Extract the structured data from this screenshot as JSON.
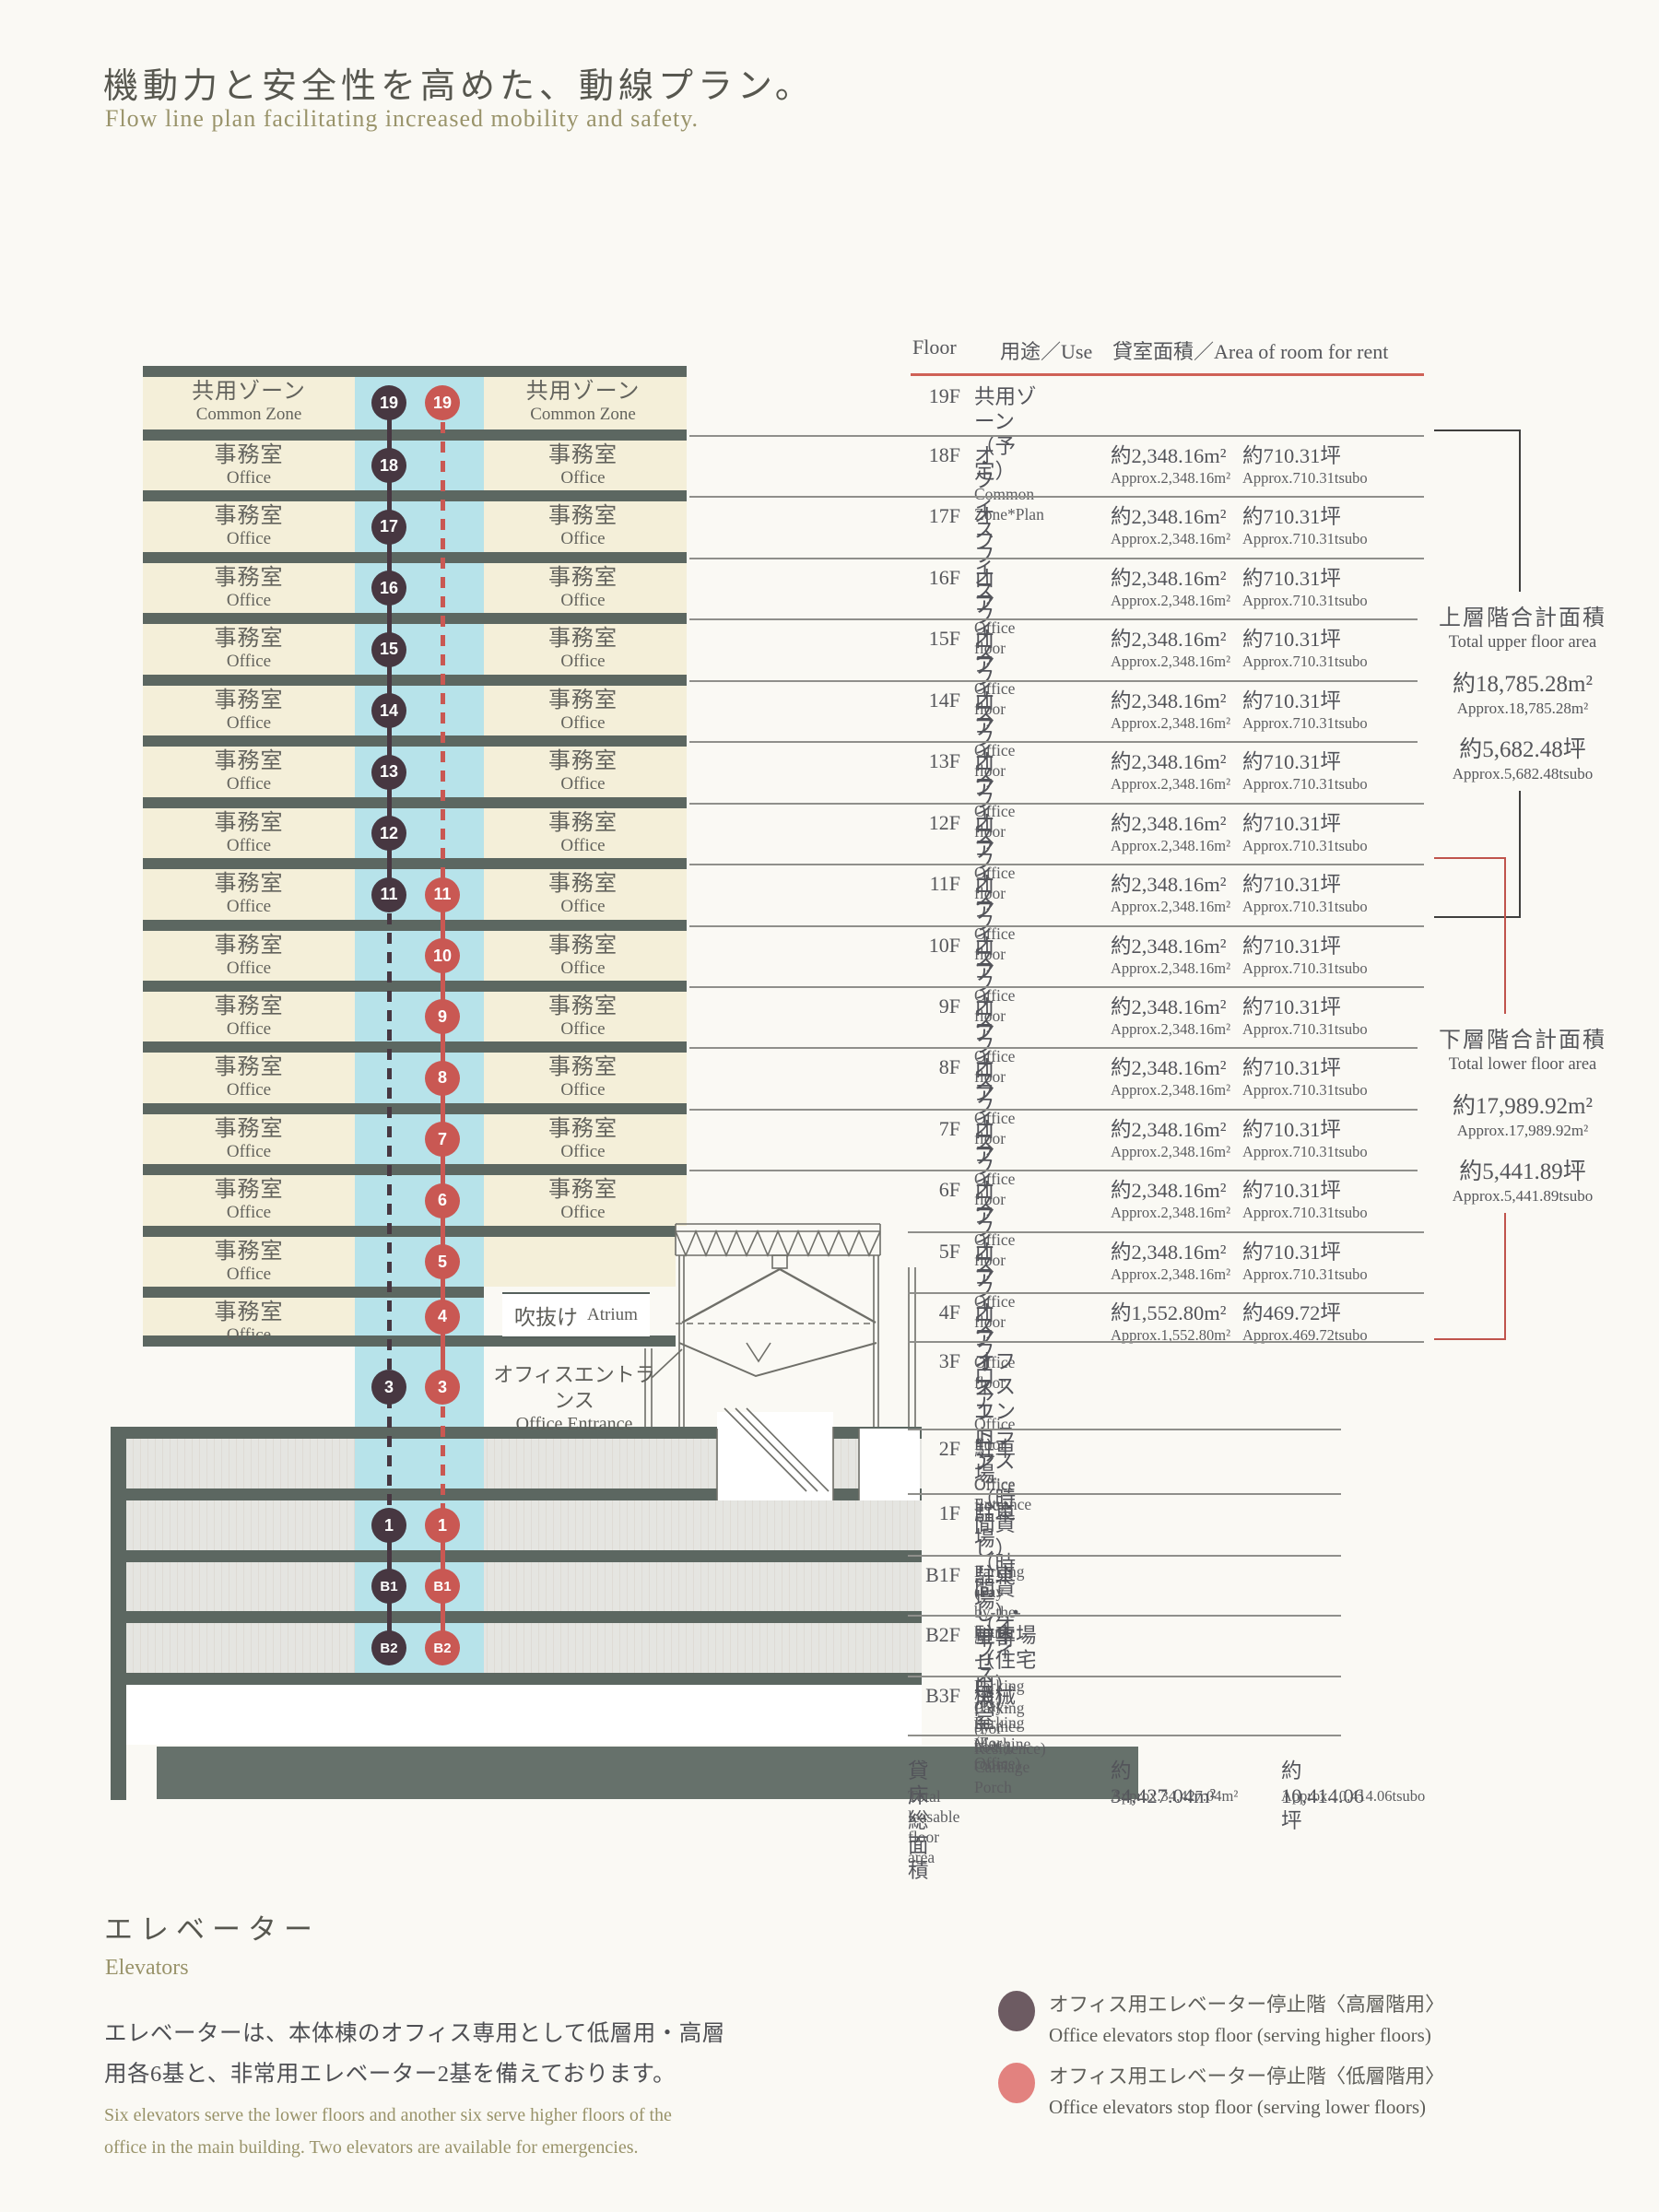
{
  "page": {
    "title_jp": "機動力と安全性を高めた、動線プラン。",
    "subtitle_en": "Flow line plan facilitating increased mobility and safety."
  },
  "colors": {
    "high_elevator": "#473741",
    "low_elevator": "#c95853",
    "legend_high": "#6d5b62",
    "legend_low": "#e2827f",
    "header_rule": "#cf6156"
  },
  "diagram": {
    "common_zone_jp": "共用ゾーン",
    "common_zone_en": "Common Zone",
    "office_jp": "事務室",
    "office_en": "Office",
    "atrium_jp": "吹抜け",
    "atrium_en": "Atrium",
    "entrance_jp": "オフィスエントランス",
    "entrance_en": "Office Entrance",
    "floors_left": [
      "19F",
      "18F",
      "17F",
      "16F",
      "15F",
      "14F",
      "13F",
      "12F",
      "11F",
      "10F",
      "9F",
      "8F",
      "7F",
      "6F",
      "5F",
      "4F"
    ],
    "floors_right": [
      "19F",
      "18F",
      "17F",
      "16F",
      "15F",
      "14F",
      "13F",
      "12F",
      "11F",
      "10F",
      "9F",
      "8F",
      "7F",
      "6F"
    ],
    "high_stops": [
      "19",
      "18",
      "17",
      "16",
      "15",
      "14",
      "13",
      "12",
      "11",
      "3",
      "1",
      "B1",
      "B2"
    ],
    "low_stops": [
      "19",
      "11",
      "10",
      "9",
      "8",
      "7",
      "6",
      "5",
      "4",
      "3",
      "1",
      "B1",
      "B2"
    ]
  },
  "table": {
    "header_floor": "Floor",
    "header_use": "用途／Use",
    "header_area": "貸室面積／Area of room for rent",
    "rows": [
      {
        "floor": "19F",
        "use_jp": "共用ゾーン（予定）",
        "use_en": "Common Zone*Plan",
        "m2_jp": "",
        "m2_en": "",
        "tsubo_jp": "",
        "tsubo_en": ""
      },
      {
        "floor": "18F",
        "use_jp": "オフィスフロア",
        "use_en": "Office floor",
        "m2_jp": "約2,348.16m²",
        "m2_en": "Approx.2,348.16m²",
        "tsubo_jp": "約710.31坪",
        "tsubo_en": "Approx.710.31tsubo"
      },
      {
        "floor": "17F",
        "use_jp": "オフィスフロア",
        "use_en": "Office floor",
        "m2_jp": "約2,348.16m²",
        "m2_en": "Approx.2,348.16m²",
        "tsubo_jp": "約710.31坪",
        "tsubo_en": "Approx.710.31tsubo"
      },
      {
        "floor": "16F",
        "use_jp": "オフィスフロア",
        "use_en": "Office floor",
        "m2_jp": "約2,348.16m²",
        "m2_en": "Approx.2,348.16m²",
        "tsubo_jp": "約710.31坪",
        "tsubo_en": "Approx.710.31tsubo"
      },
      {
        "floor": "15F",
        "use_jp": "オフィスフロア",
        "use_en": "Office floor",
        "m2_jp": "約2,348.16m²",
        "m2_en": "Approx.2,348.16m²",
        "tsubo_jp": "約710.31坪",
        "tsubo_en": "Approx.710.31tsubo"
      },
      {
        "floor": "14F",
        "use_jp": "オフィスフロア",
        "use_en": "Office floor",
        "m2_jp": "約2,348.16m²",
        "m2_en": "Approx.2,348.16m²",
        "tsubo_jp": "約710.31坪",
        "tsubo_en": "Approx.710.31tsubo"
      },
      {
        "floor": "13F",
        "use_jp": "オフィスフロア",
        "use_en": "Office floor",
        "m2_jp": "約2,348.16m²",
        "m2_en": "Approx.2,348.16m²",
        "tsubo_jp": "約710.31坪",
        "tsubo_en": "Approx.710.31tsubo"
      },
      {
        "floor": "12F",
        "use_jp": "オフィスフロア",
        "use_en": "Office floor",
        "m2_jp": "約2,348.16m²",
        "m2_en": "Approx.2,348.16m²",
        "tsubo_jp": "約710.31坪",
        "tsubo_en": "Approx.710.31tsubo"
      },
      {
        "floor": "11F",
        "use_jp": "オフィスフロア",
        "use_en": "Office floor",
        "m2_jp": "約2,348.16m²",
        "m2_en": "Approx.2,348.16m²",
        "tsubo_jp": "約710.31坪",
        "tsubo_en": "Approx.710.31tsubo"
      },
      {
        "floor": "10F",
        "use_jp": "オフィスフロア",
        "use_en": "Office floor",
        "m2_jp": "約2,348.16m²",
        "m2_en": "Approx.2,348.16m²",
        "tsubo_jp": "約710.31坪",
        "tsubo_en": "Approx.710.31tsubo"
      },
      {
        "floor": "9F",
        "use_jp": "オフィスフロア",
        "use_en": "Office floor",
        "m2_jp": "約2,348.16m²",
        "m2_en": "Approx.2,348.16m²",
        "tsubo_jp": "約710.31坪",
        "tsubo_en": "Approx.710.31tsubo"
      },
      {
        "floor": "8F",
        "use_jp": "オフィスフロア",
        "use_en": "Office floor",
        "m2_jp": "約2,348.16m²",
        "m2_en": "Approx.2,348.16m²",
        "tsubo_jp": "約710.31坪",
        "tsubo_en": "Approx.710.31tsubo"
      },
      {
        "floor": "7F",
        "use_jp": "オフィスフロア",
        "use_en": "Office floor",
        "m2_jp": "約2,348.16m²",
        "m2_en": "Approx.2,348.16m²",
        "tsubo_jp": "約710.31坪",
        "tsubo_en": "Approx.710.31tsubo"
      },
      {
        "floor": "6F",
        "use_jp": "オフィスフロア",
        "use_en": "Office floor",
        "m2_jp": "約2,348.16m²",
        "m2_en": "Approx.2,348.16m²",
        "tsubo_jp": "約710.31坪",
        "tsubo_en": "Approx.710.31tsubo"
      },
      {
        "floor": "5F",
        "use_jp": "オフィスフロア",
        "use_en": "Office floor",
        "m2_jp": "約2,348.16m²",
        "m2_en": "Approx.2,348.16m²",
        "tsubo_jp": "約710.31坪",
        "tsubo_en": "Approx.710.31tsubo"
      },
      {
        "floor": "4F",
        "use_jp": "オフィスフロア",
        "use_en": "Office floor",
        "m2_jp": "約1,552.80m²",
        "m2_en": "Approx.1,552.80m²",
        "tsubo_jp": "約469.72坪",
        "tsubo_en": "Approx.469.72tsubo"
      },
      {
        "floor": "3F",
        "use_jp": "オフィスエントランス",
        "use_en": "Office Entrance",
        "m2_jp": "",
        "m2_en": "",
        "tsubo_jp": "",
        "tsubo_en": ""
      },
      {
        "floor": "2F",
        "use_jp": "駐車場（時間貸し）",
        "use_en": "Parking (Pay-by-the-hour)",
        "m2_jp": "",
        "m2_en": "",
        "tsubo_jp": "",
        "tsubo_en": ""
      },
      {
        "floor": "1F",
        "use_jp": "駐車場（時間貸し）・車寄せ",
        "use_en": "Parking (Pay-by-the-hour), Carriage Porch",
        "m2_jp": "",
        "m2_en": "",
        "tsubo_jp": "",
        "tsubo_en": ""
      },
      {
        "floor": "B1F",
        "use_jp": "駐車場（オフィス用）",
        "use_en": "Parking (For Office)",
        "m2_jp": "",
        "m2_en": "",
        "tsubo_jp": "",
        "tsubo_en": ""
      },
      {
        "floor": "B2F",
        "use_jp": "駐車場（住宅用）",
        "use_en": "Parking (For Residence)",
        "m2_jp": "",
        "m2_en": "",
        "tsubo_jp": "",
        "tsubo_en": ""
      },
      {
        "floor": "B3F",
        "use_jp": "機械室",
        "use_en": "Machine room",
        "m2_jp": "",
        "m2_en": "",
        "tsubo_jp": "",
        "tsubo_en": ""
      }
    ],
    "total": {
      "label_jp": "貸床総面積",
      "label_en": "Total leasable floor area",
      "m2_jp": "約34,427.04m²",
      "m2_en": "Approx.34,427.04m²",
      "tsubo_jp": "約10,414.06坪",
      "tsubo_en": "Approx.10,414.06tsubo"
    }
  },
  "summary_upper": {
    "jp": "上層階合計面積",
    "en": "Total upper floor area",
    "m2_jp": "約18,785.28m²",
    "m2_en": "Approx.18,785.28m²",
    "tsubo_jp": "約5,682.48坪",
    "tsubo_en": "Approx.5,682.48tsubo"
  },
  "summary_lower": {
    "jp": "下層階合計面積",
    "en": "Total lower floor area",
    "m2_jp": "約17,989.92m²",
    "m2_en": "Approx.17,989.92m²",
    "tsubo_jp": "約5,441.89坪",
    "tsubo_en": "Approx.5,441.89tsubo"
  },
  "elevators": {
    "heading_jp": "エレベーター",
    "heading_en": "Elevators",
    "body_jp_lines": [
      "エレベーターは、本体棟のオフィス専用として低層用・高層",
      "用各6基と、非常用エレベーター2基を備えております。"
    ],
    "body_en_lines": [
      "Six elevators serve the lower floors and another six serve higher floors of the",
      "office in the main building. Two elevators are available for emergencies."
    ],
    "legend": [
      {
        "jp": "オフィス用エレベーター停止階〈高層階用〉",
        "en": "Office elevators stop floor (serving higher floors)"
      },
      {
        "jp": "オフィス用エレベーター停止階〈低層階用〉",
        "en": "Office elevators stop floor (serving lower floors)"
      }
    ]
  }
}
